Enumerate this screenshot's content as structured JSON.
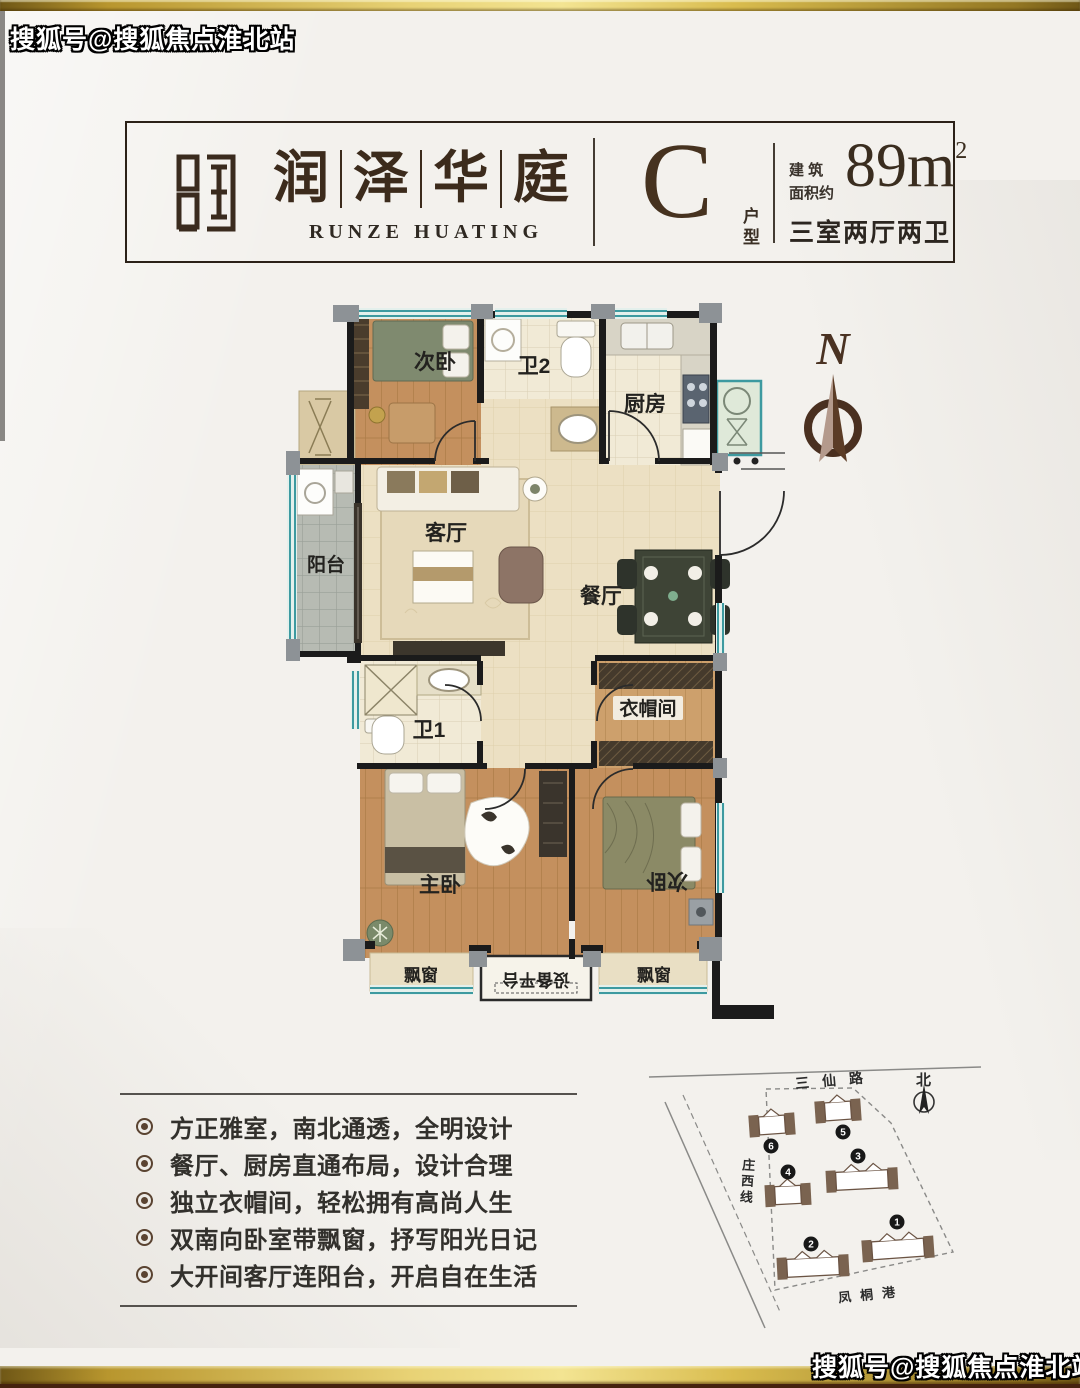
{
  "watermarks": {
    "top_left": "搜狐号@搜狐焦点淮北站",
    "bottom_right": "搜狐号@搜狐焦点淮北站"
  },
  "header": {
    "brand_cn_chars": [
      "润",
      "泽",
      "华",
      "庭"
    ],
    "brand_en": "RUNZE HUATING",
    "unit_letter": "C",
    "unit_suffix_chars": [
      "户",
      "型"
    ],
    "area_label_line1": "建 筑",
    "area_label_line2": "面积约",
    "area_value": "89m",
    "area_sup": "2",
    "rooms_summary": "三室两厅两卫"
  },
  "floorplan": {
    "compass_letter": "N",
    "labels": {
      "bedroom2_top": "次卧",
      "bath2": "卫2",
      "kitchen": "厨房",
      "balcony": "阳台",
      "living": "客厅",
      "dining": "餐厅",
      "bath1": "卫1",
      "cloakroom": "衣帽间",
      "master": "主卧",
      "bedroom2_bottom": "次卧",
      "bay_left": "飘窗",
      "equipment": "设备平台",
      "bay_right": "飘窗"
    }
  },
  "features": {
    "items": [
      "方正雅室，南北通透，全明设计",
      "餐厅、厨房直通布局，设计合理",
      "独立衣帽间，轻松拥有高尚人生",
      "双南向卧室带飘窗，抒写阳光日记",
      "大开间客厅连阳台，开启自在生活"
    ]
  },
  "siteplan": {
    "road_top": "三仙路",
    "road_left": "庄西线",
    "road_bottom": "凤桐港",
    "north_label": "北",
    "building_numbers": [
      "1",
      "2",
      "3",
      "4",
      "5",
      "6"
    ]
  },
  "colors": {
    "gold": "#e8d275",
    "dark_brown": "#3c2b1c",
    "wall": "#1b1b1b",
    "window_teal": "#3d9aa0"
  }
}
